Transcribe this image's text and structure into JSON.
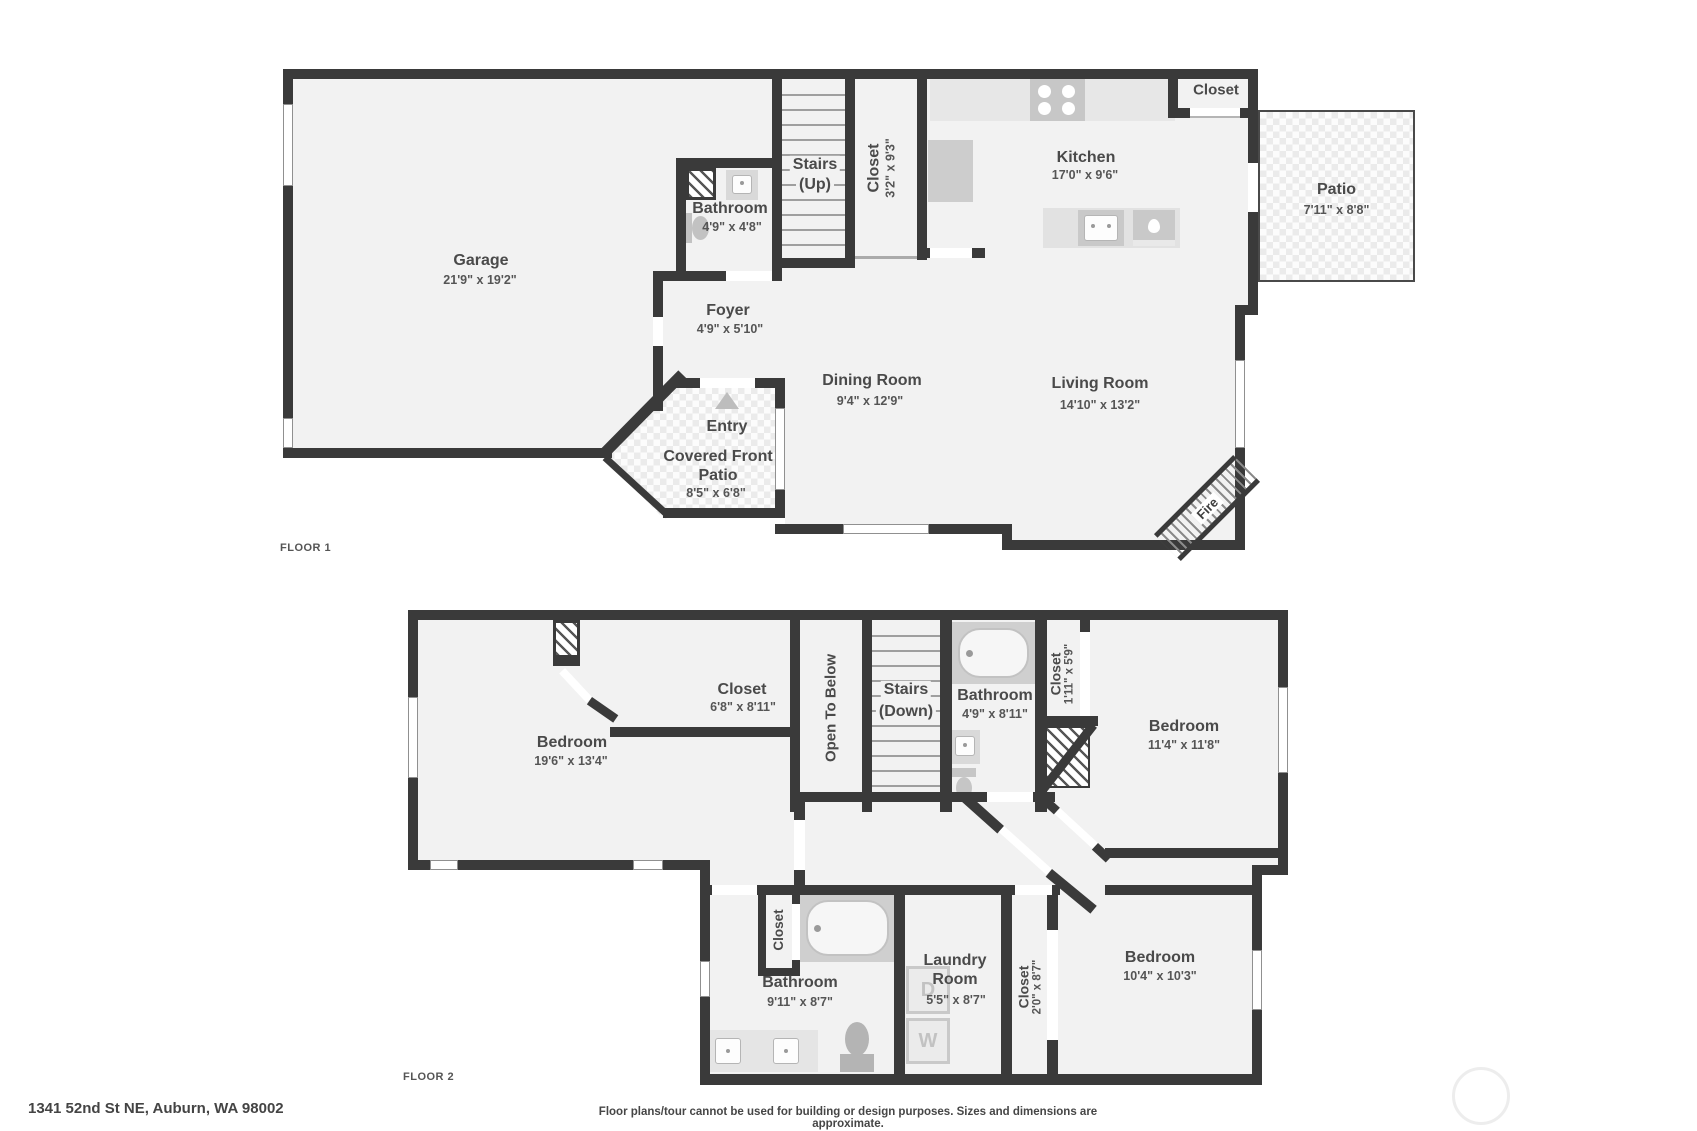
{
  "page": {
    "floor1_label": "FLOOR 1",
    "floor2_label": "FLOOR 2",
    "address": "1341 52nd St NE, Auburn, WA 98002",
    "disclaimer": "Floor plans/tour cannot be used for building or design purposes. Sizes and dimensions are approximate."
  },
  "floor1": {
    "garage": {
      "name": "Garage",
      "dims": "21'9\" x 19'2\""
    },
    "bathroom": {
      "name": "Bathroom",
      "dims": "4'9\" x 4'8\""
    },
    "stairs": {
      "line1": "Stairs",
      "line2": "(Up)"
    },
    "stairs_closet": {
      "name": "Closet",
      "dims": "3'2\" x 9'3\""
    },
    "kitchen": {
      "name": "Kitchen",
      "dims": "17'0\" x 9'6\""
    },
    "kitchen_closet": {
      "name": "Closet"
    },
    "patio": {
      "name": "Patio",
      "dims": "7'11\" x 8'8\""
    },
    "foyer": {
      "name": "Foyer",
      "dims": "4'9\" x 5'10\""
    },
    "dining": {
      "name": "Dining Room",
      "dims": "9'4\" x 12'9\""
    },
    "living": {
      "name": "Living Room",
      "dims": "14'10\" x 13'2\""
    },
    "entry": {
      "name": "Entry"
    },
    "covered_patio": {
      "name": "Covered Front Patio",
      "dims": "8'5\" x 6'8\""
    },
    "fireplace": {
      "label": "Fire"
    }
  },
  "floor2": {
    "bedroom1": {
      "name": "Bedroom",
      "dims": "19'6\" x 13'4\""
    },
    "closet_top": {
      "name": "Closet",
      "dims": "6'8\" x 8'11\""
    },
    "open_to_below": {
      "name": "Open To Below"
    },
    "stairs": {
      "line1": "Stairs",
      "line2": "(Down)"
    },
    "bathroom_up": {
      "name": "Bathroom",
      "dims": "4'9\" x 8'11\""
    },
    "closet_small": {
      "name": "Closet",
      "dims": "1'11\" x 5'9\""
    },
    "bedroom2": {
      "name": "Bedroom",
      "dims": "11'4\" x 11'8\""
    },
    "closet_bath": {
      "name": "Closet"
    },
    "bathroom_low": {
      "name": "Bathroom",
      "dims": "9'11\" x 8'7\""
    },
    "laundry": {
      "name": "Laundry Room",
      "dims": "5'5\" x 8'7\""
    },
    "closet_hall": {
      "name": "Closet",
      "dims": "2'0\" x 8'7\""
    },
    "bedroom3": {
      "name": "Bedroom",
      "dims": "10'4\" x 10'3\""
    },
    "washer": "W",
    "dryer": "D"
  },
  "colors": {
    "wall": "#3a3a3a",
    "floor": "#f2f2f2",
    "fixture": "#c9c9c9",
    "label": "#4a4a4a"
  }
}
